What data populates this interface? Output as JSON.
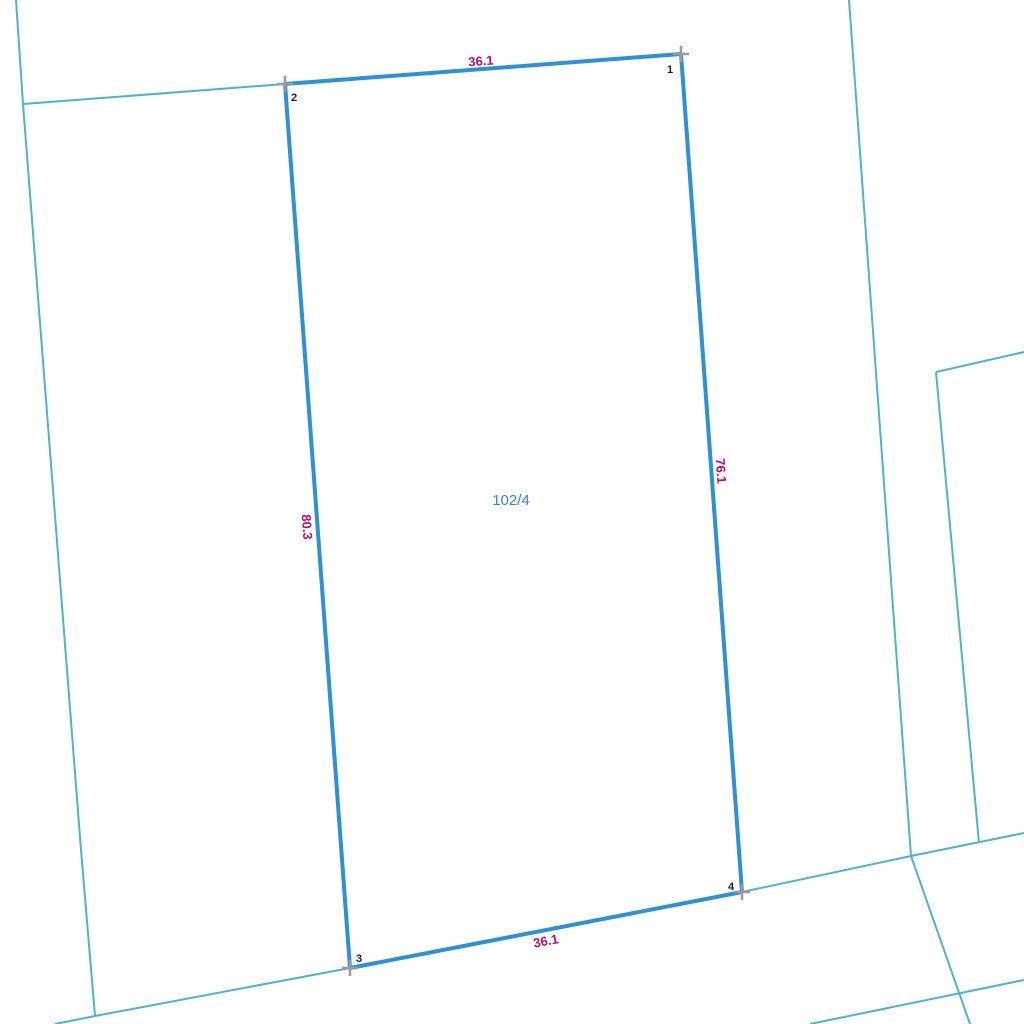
{
  "map": {
    "background_color": "#ffffff",
    "colors": {
      "selected_parcel_boundary": "#2e91d4",
      "neighbor_boundary": "#4fb2ce",
      "measurement_text": "#b5106e",
      "parcel_number_text": "#3f82c6",
      "vertex_marker": "#9a9a9a",
      "vertex_number_text": "#222222"
    },
    "selected_parcel": {
      "number": "102/4",
      "number_label_pos": {
        "x": 511,
        "y": 505
      },
      "vertices": [
        {
          "n": "1",
          "x": 681,
          "y": 54,
          "lx": 670,
          "ly": 73
        },
        {
          "n": "2",
          "x": 285,
          "y": 84,
          "lx": 294,
          "ly": 101
        },
        {
          "n": "3",
          "x": 350,
          "y": 968,
          "lx": 359,
          "ly": 962
        },
        {
          "n": "4",
          "x": 742,
          "y": 892,
          "lx": 731,
          "ly": 890
        }
      ],
      "edges": [
        {
          "a": 1,
          "b": 0,
          "measurement": "36.1",
          "label": {
            "x": 481,
            "y": 62,
            "rotate": -4.3
          }
        },
        {
          "a": 0,
          "b": 3,
          "measurement": "76.1",
          "label": {
            "x": 720,
            "y": 471,
            "rotate": 85.8
          }
        },
        {
          "a": 1,
          "b": 2,
          "measurement": "80.3",
          "label": {
            "x": 306,
            "y": 527,
            "rotate": 85.8
          }
        },
        {
          "a": 2,
          "b": 3,
          "measurement": "36.1",
          "label": {
            "x": 546,
            "y": 942,
            "rotate": -11
          }
        }
      ]
    },
    "neighbor_lines": [
      {
        "name": "left-boundary",
        "points": [
          [
            16,
            0
          ],
          [
            23,
            104
          ],
          [
            81,
            850
          ],
          [
            95,
            1016
          ]
        ]
      },
      {
        "name": "top-neighbor-segment",
        "points": [
          [
            23,
            104
          ],
          [
            285,
            84
          ]
        ]
      },
      {
        "name": "bottom-left-boundary",
        "points": [
          [
            55,
            1024
          ],
          [
            95,
            1016
          ],
          [
            350,
            968
          ]
        ]
      },
      {
        "name": "bottom-right-boundary",
        "points": [
          [
            742,
            892
          ],
          [
            911,
            856
          ],
          [
            1024,
            833
          ]
        ]
      },
      {
        "name": "right-boundary",
        "points": [
          [
            849,
            0
          ],
          [
            911,
            856
          ],
          [
            970,
            1024
          ]
        ]
      },
      {
        "name": "east-parcel-top",
        "points": [
          [
            936,
            372
          ],
          [
            1024,
            352
          ]
        ]
      },
      {
        "name": "east-parcel-side",
        "points": [
          [
            936,
            372
          ],
          [
            979,
            843
          ]
        ]
      },
      {
        "name": "bottom-corner-line",
        "points": [
          [
            810,
            1024
          ],
          [
            1024,
            980
          ]
        ]
      }
    ]
  }
}
